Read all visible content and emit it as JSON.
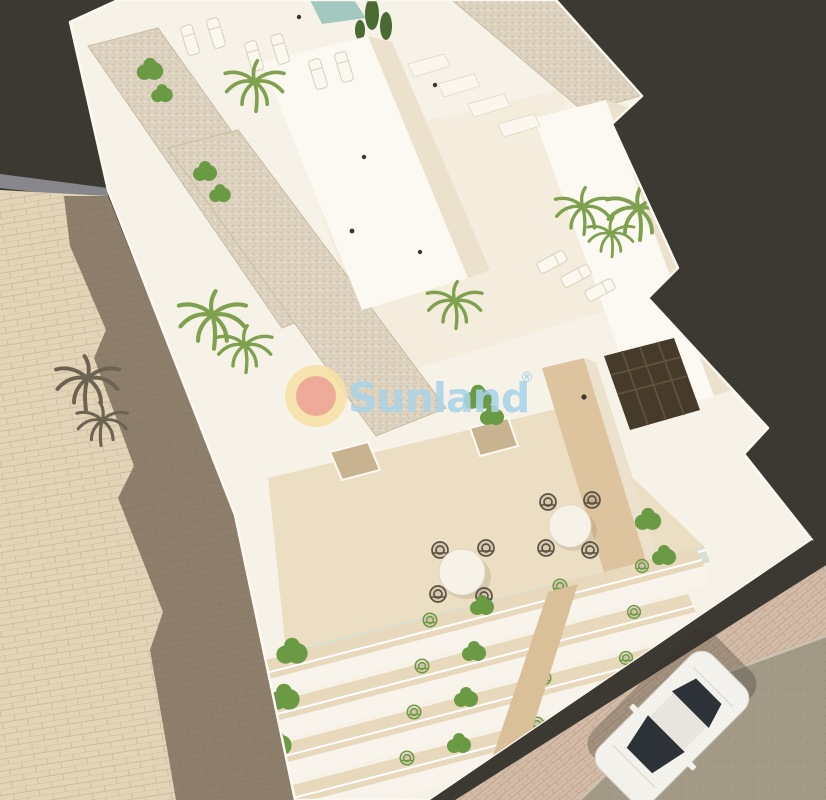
{
  "image": {
    "kind": "3d-architectural-render",
    "view": "aerial",
    "subject": "White residential building with rooftop terraces, sun loungers, palm trees, balcony floors, neighbouring beige wall, street with parked white car"
  },
  "watermark": {
    "brand_text": "Sunland",
    "registered_symbol": "®"
  },
  "palette": {
    "background_dark": "#3c3933",
    "building_white": "#f7f2e8",
    "building_bright": "#fcf9f2",
    "building_shade": "#ece1cc",
    "gravel": "#dcd2bf",
    "terrace_floor": "#ecdec2",
    "divider_wood": "#ddc49e",
    "column_wood": "#d9c098",
    "neighbor_wall": "#e3d3b7",
    "neighbor_wall_shadow": "#8d7f6b",
    "wall_cap_gray": "#87868b",
    "road": "#a29a87",
    "sidewalk": "#d2bba7",
    "glass_tint": "#bccbb9",
    "palm_green": "#7fa14f",
    "bush_green": "#6b9a45",
    "shadow_palm": "#6d6352",
    "chair_wicker": "#5c5244",
    "pergola_dark": "#463a2b",
    "pool_teal": "#a3c8bf",
    "car_body": "#f3f1eb",
    "car_glass": "#2c3237",
    "logo_blue": "#a9d4e9",
    "sun_outer": "#f6e2a6",
    "sun_inner": "#efa28f"
  }
}
